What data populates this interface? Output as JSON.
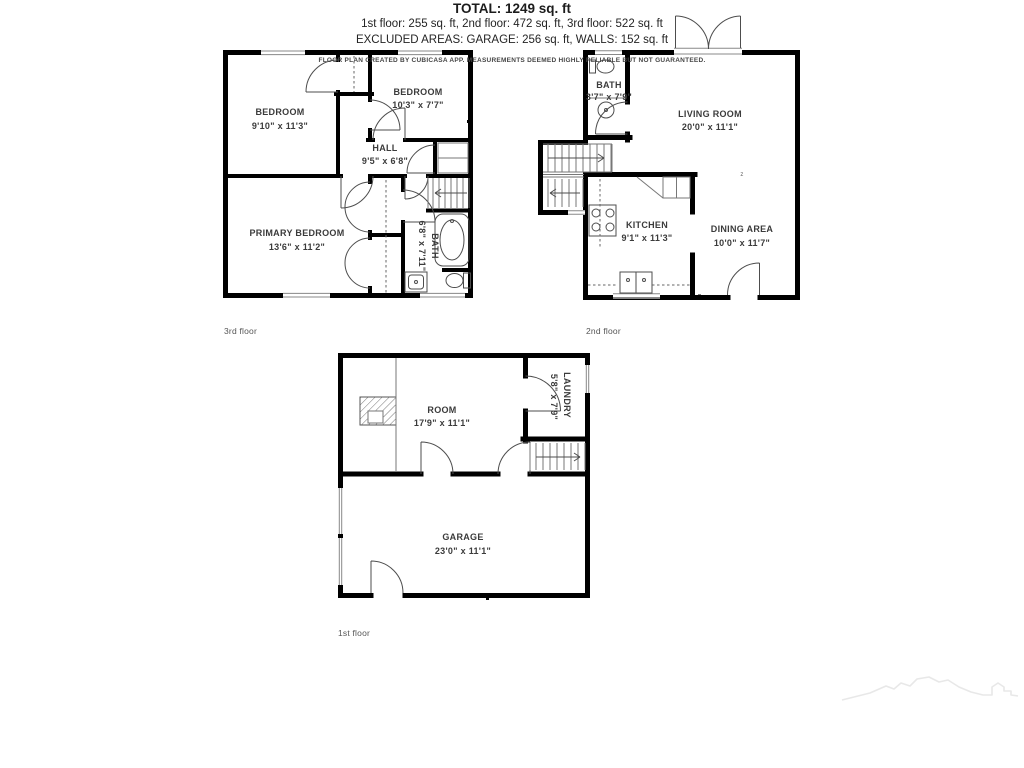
{
  "colors": {
    "wall": "#000000",
    "label": "#3b3b3b",
    "sketch": "#e8e8e8"
  },
  "floors": {
    "third": {
      "label": "3rd floor",
      "rooms": {
        "bedroom1": {
          "name": "BEDROOM",
          "dims": "9'10\" x 11'3\""
        },
        "bedroom2": {
          "name": "BEDROOM",
          "dims": "10'3\" x 7'7\""
        },
        "hall": {
          "name": "HALL",
          "dims": "9'5\" x 6'8\""
        },
        "primary": {
          "name": "PRIMARY BEDROOM",
          "dims": "13'6\" x 11'2\""
        },
        "bath": {
          "name": "BATH",
          "dims": "6'8\" x 7'11\""
        }
      }
    },
    "second": {
      "label": "2nd floor",
      "rooms": {
        "bath": {
          "name": "BATH",
          "dims": "3'7\" x 7'9\""
        },
        "living": {
          "name": "LIVING ROOM",
          "dims": "20'0\" x 11'1\""
        },
        "kitchen": {
          "name": "KITCHEN",
          "dims": "9'1\" x 11'3\""
        },
        "dining": {
          "name": "DINING AREA",
          "dims": "10'0\" x 11'7\""
        },
        "marker": "z"
      }
    },
    "first": {
      "label": "1st floor",
      "rooms": {
        "room": {
          "name": "ROOM",
          "dims": "17'9\" x 11'1\""
        },
        "laundry": {
          "name": "LAUNDRY",
          "dims": "5'8\" x 7'9\""
        },
        "garage": {
          "name": "GARAGE",
          "dims": "23'0\" x 11'1\""
        }
      }
    }
  },
  "summary": {
    "total": "TOTAL: 1249 sq. ft",
    "floors_line": "1st floor: 255 sq. ft, 2nd floor: 472 sq. ft, 3rd floor: 522 sq. ft",
    "excluded_line": "EXCLUDED AREAS: GARAGE: 256 sq. ft, WALLS: 152 sq. ft",
    "disclaimer": "FLOOR PLAN CREATED BY CUBICASA APP. MEASUREMENTS DEEMED HIGHLY RELIABLE BUT NOT GUARANTEED."
  }
}
